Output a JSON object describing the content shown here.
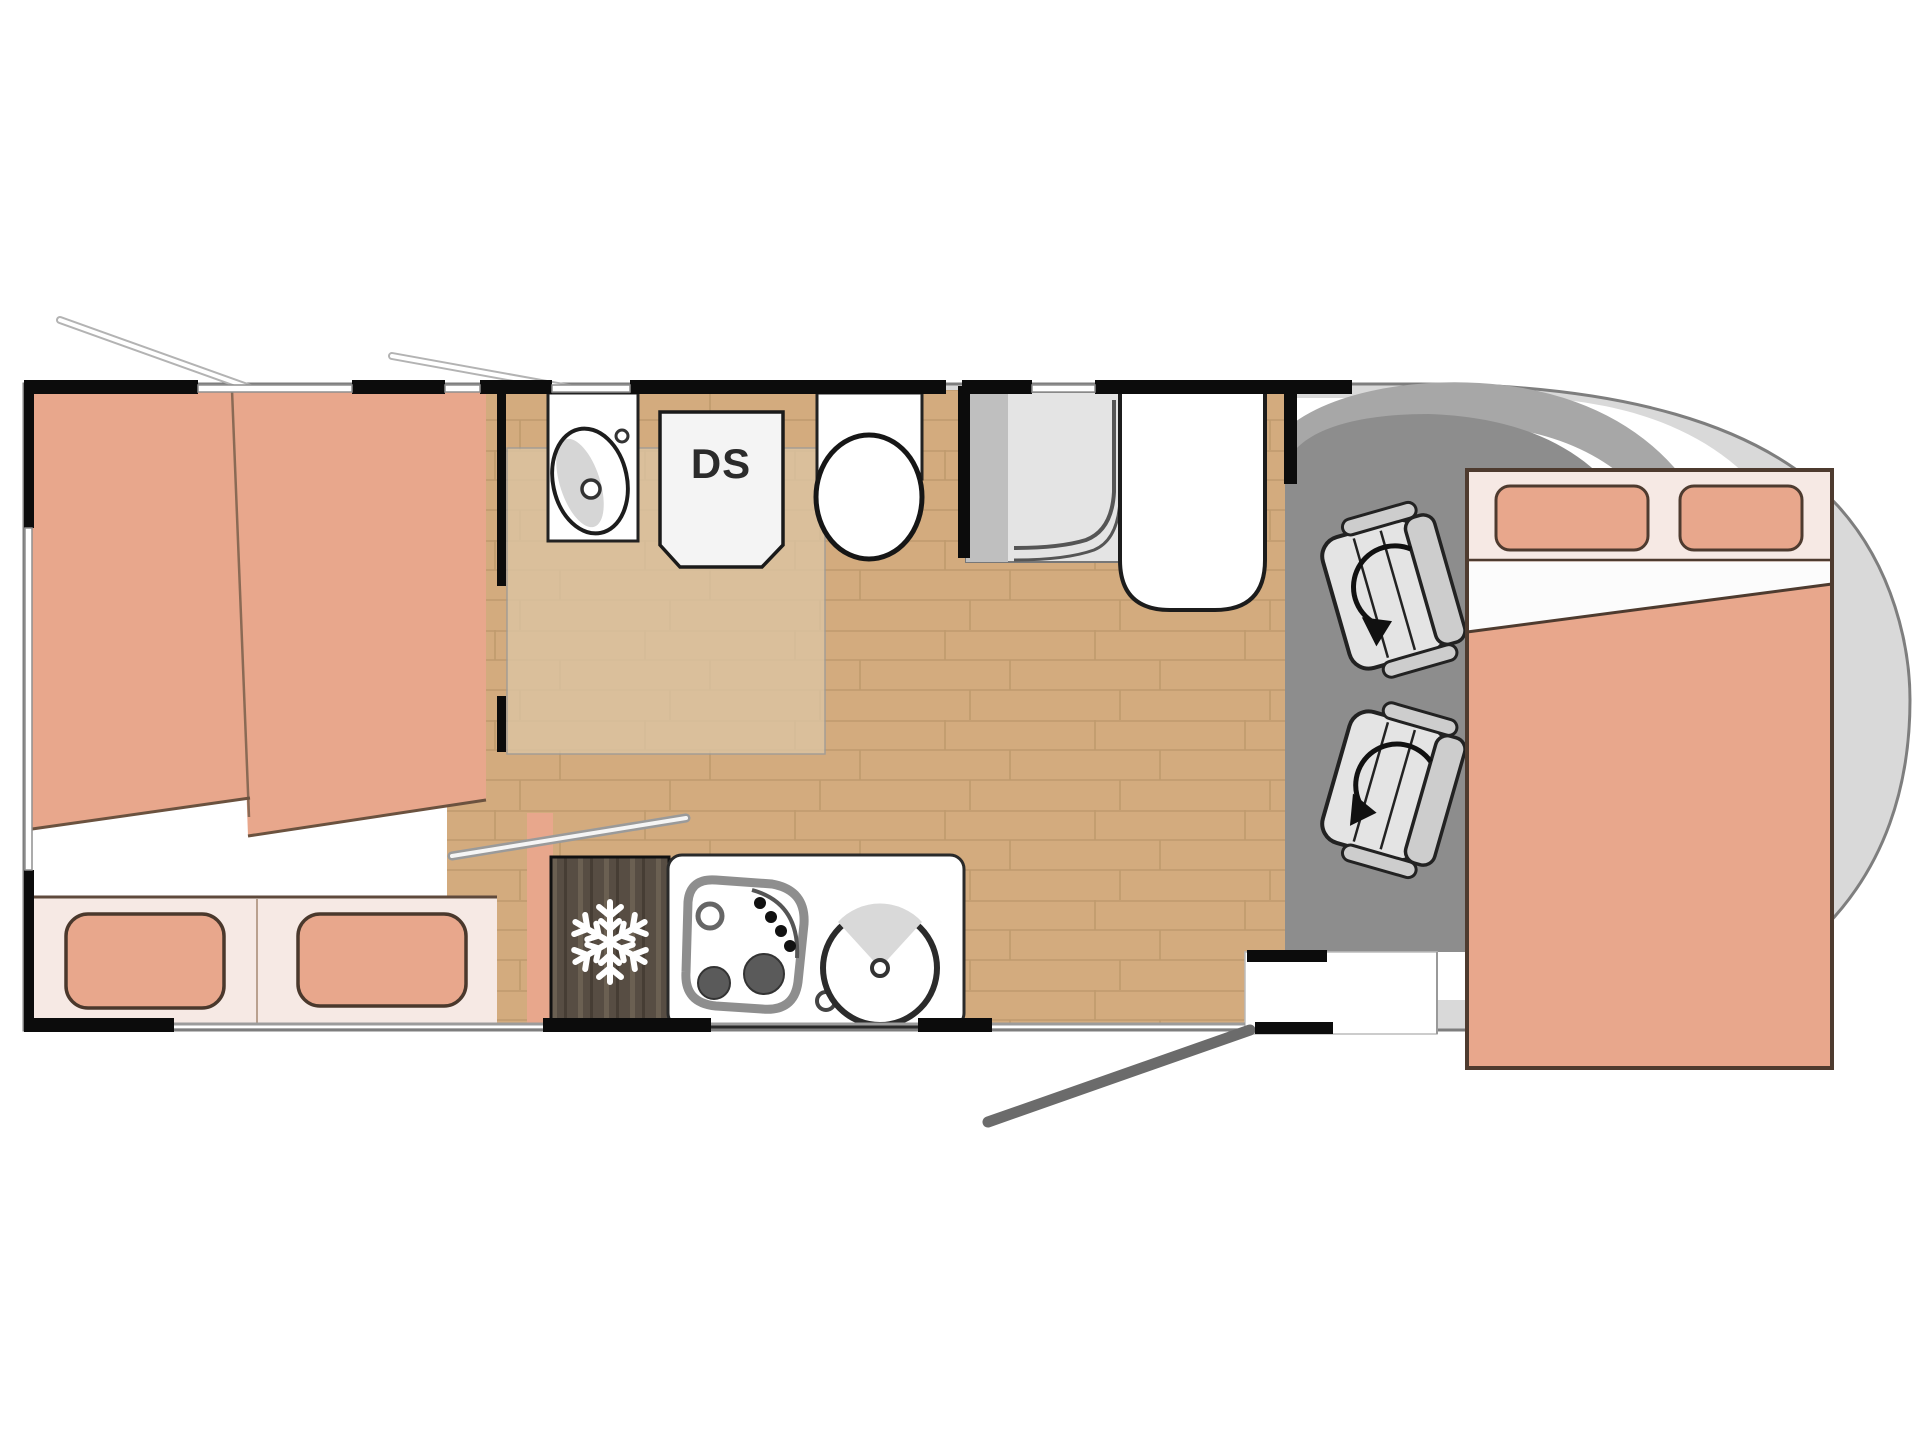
{
  "floorplan": {
    "labels": {
      "shower_cabinet": "DS"
    },
    "colors": {
      "background": "#ffffff",
      "wall": "#0c0c0c",
      "body_fill": "#d9d9d9",
      "body_outline": "#7e7e7e",
      "cab_interior": "#ffffff",
      "dashboard": "#a7a7a7",
      "cab_floor": "#8d8d8d",
      "floor_wood": "#d3ab7e",
      "floor_plank_line": "#bf9a6d",
      "bathroom_floor": "#dcc5a3",
      "mattress": "#e8a78c",
      "bed_base": "#f6e9e4",
      "pillow": "#e8a78c",
      "pillow_outline": "#4a382c",
      "bed_outline": "#4e3b2f",
      "fixture_white": "#ffffff",
      "fixture_outline": "#222222",
      "fridge_wood": "#574d43",
      "fridge_streak": "#6b6052",
      "snowflake": "#ffffff",
      "shower_tray": "#e4e4e4",
      "shower_panel": "#bfbfbf",
      "seat_light": "#e4e4e4",
      "seat_mid": "#cdcdcd",
      "seat_outline": "#222222",
      "door_swing": "#6b6b6b",
      "hob_ring": "#8e8e8e",
      "burner_dark": "#5a5a5a",
      "window_line": "#8f8f8f",
      "divider_line": "#8a6a55"
    },
    "icons": {
      "snowflake-icon": "fridge / freezer symbol (6-arm snowflake)",
      "rotation-arrow-icon": "seat swivel curved arrow",
      "door-swing-icon": "entry door opening diagonal line",
      "awning-arm-icon": "open window stay arm"
    },
    "legend": [
      "rear-twin-beds",
      "washroom-sink",
      "shower-cabinet-DS",
      "toilet",
      "shower-tray",
      "wardrobe",
      "fridge",
      "hob",
      "kitchen-sink",
      "swivel-cab-seats",
      "overcab-double-bed",
      "entry-door"
    ]
  }
}
